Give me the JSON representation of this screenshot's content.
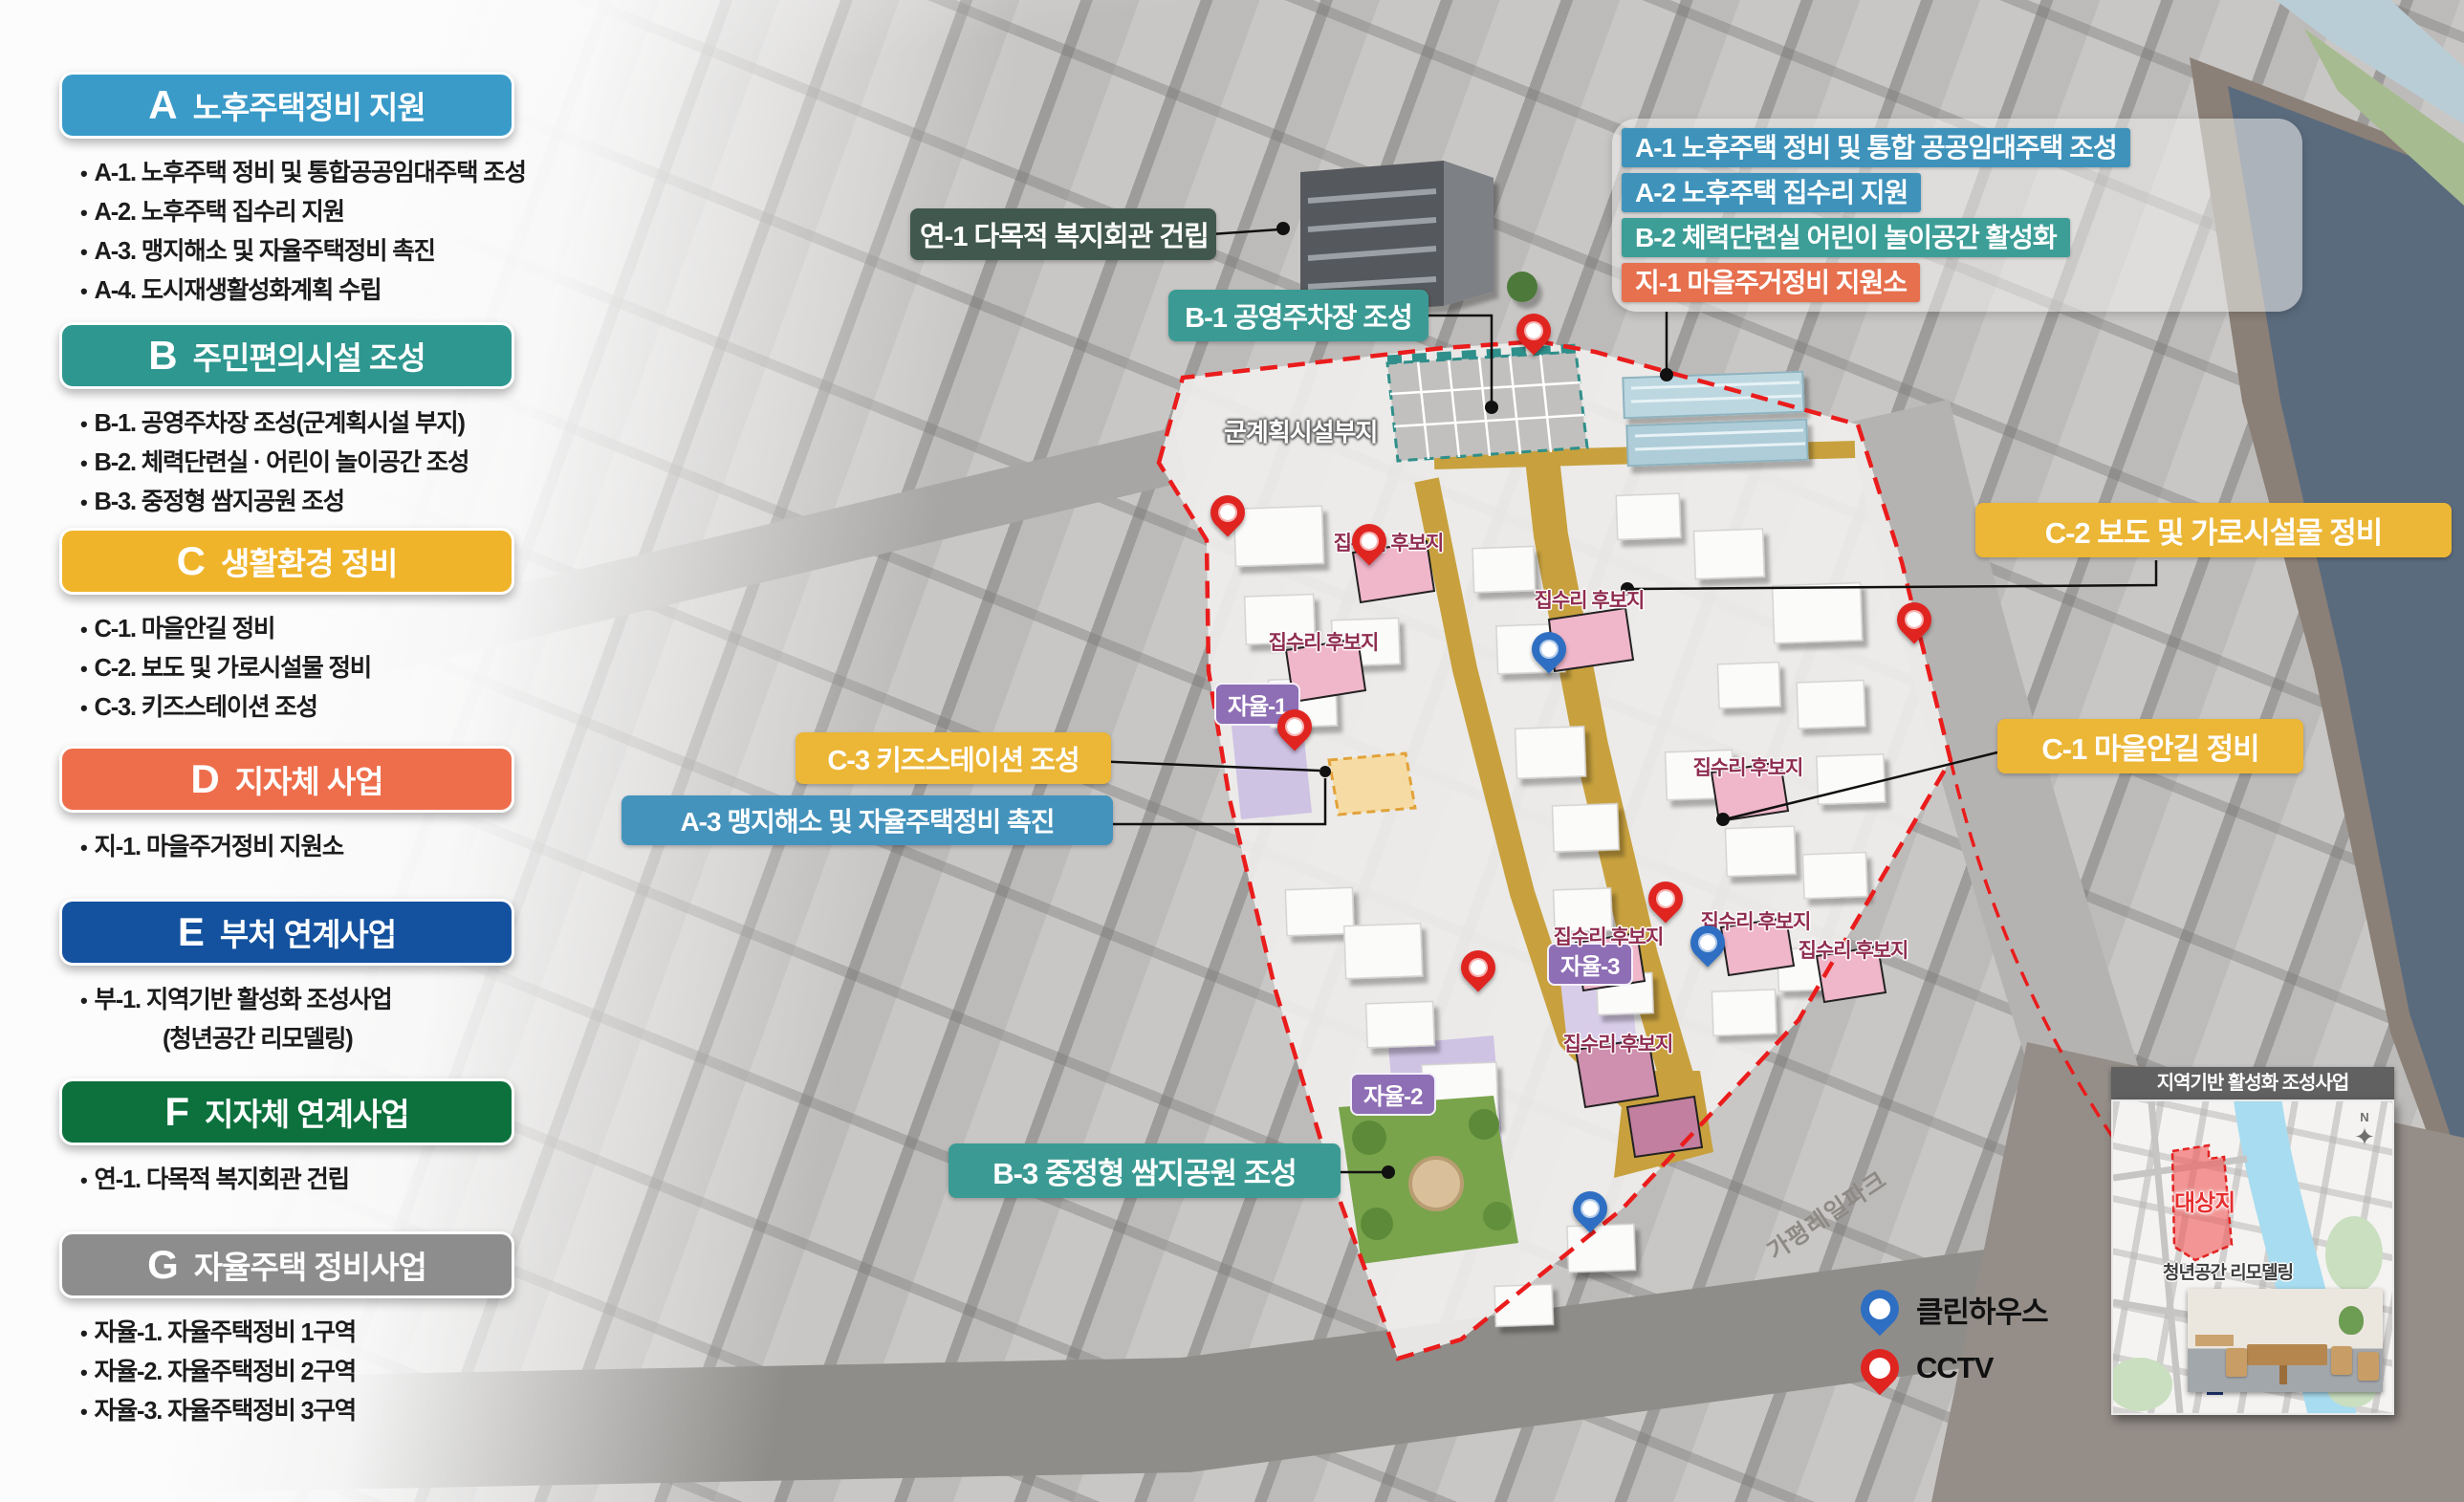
{
  "sidebar": {
    "sections": [
      {
        "code": "A",
        "title": "노후주택정비 지원",
        "color": "#3a9bc9",
        "items": [
          {
            "text": "A-1. 노후주택 정비 및 통합공공임대주택 조성"
          },
          {
            "text": "A-2. 노후주택 집수리 지원"
          },
          {
            "text": "A-3. 맹지해소 및 자율주택정비 촉진"
          },
          {
            "text": "A-4. 도시재생활성화계획 수립"
          }
        ]
      },
      {
        "code": "B",
        "title": "주민편의시설 조성",
        "color": "#2e9790",
        "items": [
          {
            "text": "B-1. 공영주차장 조성(군계획시설 부지)"
          },
          {
            "text": "B-2. 체력단련실 · 어린이 놀이공간 조성"
          },
          {
            "text": "B-3. 중정형 쌈지공원 조성"
          }
        ]
      },
      {
        "code": "C",
        "title": "생활환경 정비",
        "color": "#f0b42b",
        "items": [
          {
            "text": "C-1. 마을안길 정비"
          },
          {
            "text": "C-2. 보도 및 가로시설물 정비"
          },
          {
            "text": "C-3. 키즈스테이션 조성"
          }
        ]
      },
      {
        "code": "D",
        "title": "지자체 사업",
        "color": "#ee6e4c",
        "items": [
          {
            "text": "지-1. 마을주거정비 지원소"
          }
        ]
      },
      {
        "code": "E",
        "title": "부처 연계사업",
        "color": "#14529f",
        "items": [
          {
            "text": "부-1. 지역기반 활성화 조성사업"
          },
          {
            "text": "(청년공간 리모델링)",
            "indent": true
          }
        ]
      },
      {
        "code": "F",
        "title": "지자체 연계사업",
        "color": "#0d713d",
        "items": [
          {
            "text": "연-1. 다목적 복지회관 건립"
          }
        ]
      },
      {
        "code": "G",
        "title": "자율주택 정비사업",
        "color": "#8d8d8d",
        "items": [
          {
            "text": "자율-1. 자율주택정비 1구역"
          },
          {
            "text": "자율-2. 자율주택정비 2구역"
          },
          {
            "text": "자율-3. 자율주택정비 3구역"
          }
        ]
      }
    ]
  },
  "map": {
    "callouts": {
      "yeon1": {
        "text": "연-1 다목적 복지회관 건립",
        "color": "#41584e"
      },
      "b1": {
        "text": "B-1 공영주차장 조성",
        "color": "#3b9b94"
      },
      "c2": {
        "text": "C-2 보도 및 가로시설물 정비",
        "color": "#ecb636"
      },
      "c1": {
        "text": "C-1 마을안길 정비",
        "color": "#ecb636"
      },
      "c3": {
        "text": "C-3 키즈스테이션 조성",
        "color": "#ecb636"
      },
      "a3": {
        "text": "A-3 맹지해소 및 자율주택정비 촉진",
        "color": "#4493bc"
      },
      "b3": {
        "text": "B-3 중정형 쌈지공원 조성",
        "color": "#3b9b94"
      }
    },
    "callout_card": {
      "rows": [
        {
          "text": "A-1 노후주택 정비 및 통합 공공임대주택 조성",
          "color": "#3f93bb"
        },
        {
          "text": "A-2 노후주택 집수리 지원",
          "color": "#3f93bb"
        },
        {
          "text": "B-2 체력단련실 어린이 놀이공간 활성화",
          "color": "#3d9e97"
        },
        {
          "text": "지-1 마을주거정비 지원소",
          "color": "#e7704e"
        }
      ]
    },
    "zone_labels": [
      {
        "text": "자율-1"
      },
      {
        "text": "자율-2"
      },
      {
        "text": "자율-3"
      }
    ],
    "repair_label": "집수리 후보지",
    "parcel_label": "군계획시설부지",
    "road_label": "가평레일파크",
    "legend": [
      {
        "text": "클린하우스",
        "pin": "blue",
        "color": "#2e6fc3"
      },
      {
        "text": "CCTV",
        "pin": "red",
        "color": "#e02521"
      }
    ],
    "inset": {
      "title": "지역기반 활성화 조성사업",
      "site": "대상지",
      "youth": "청년공간 리모델링"
    }
  }
}
